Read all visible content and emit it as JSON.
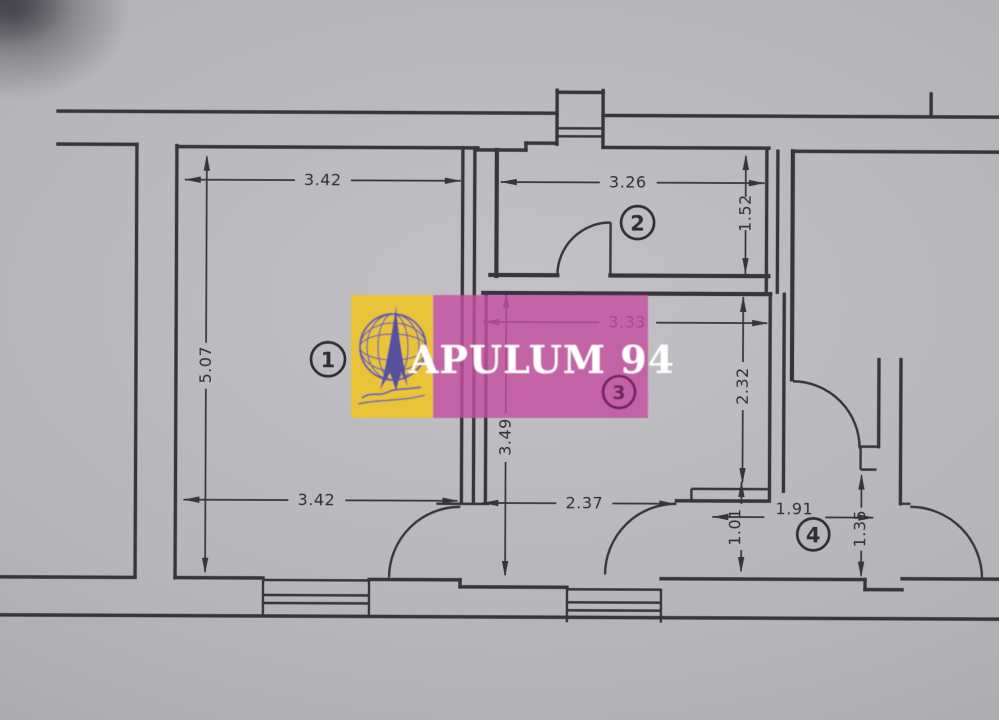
{
  "photo": {
    "paper_color": "#b5b5b9",
    "ink_color": "#35353d"
  },
  "watermark": {
    "brand_text": "APULUM 94",
    "logo_name": "apulum-compass-globe-logo",
    "yellow_hex": "#edc32d",
    "pink_hex": "#c44fa0",
    "text_color": "#ffffff"
  },
  "rooms": [
    {
      "number": "1"
    },
    {
      "number": "2"
    },
    {
      "number": "3"
    },
    {
      "number": "4"
    }
  ],
  "dimensions": {
    "room1_width_top": "3.42",
    "room1_height": "5.07",
    "room1_width_bottom": "3.42",
    "room2_width": "3.26",
    "room2_height": "1.52",
    "room3_width": "3.33",
    "room3_height": "2.32",
    "hall_height": "3.49",
    "hall_width": "2.37",
    "room4_width": "1.91",
    "room4_height_left": "1.01",
    "room4_height_right": "1.35"
  }
}
